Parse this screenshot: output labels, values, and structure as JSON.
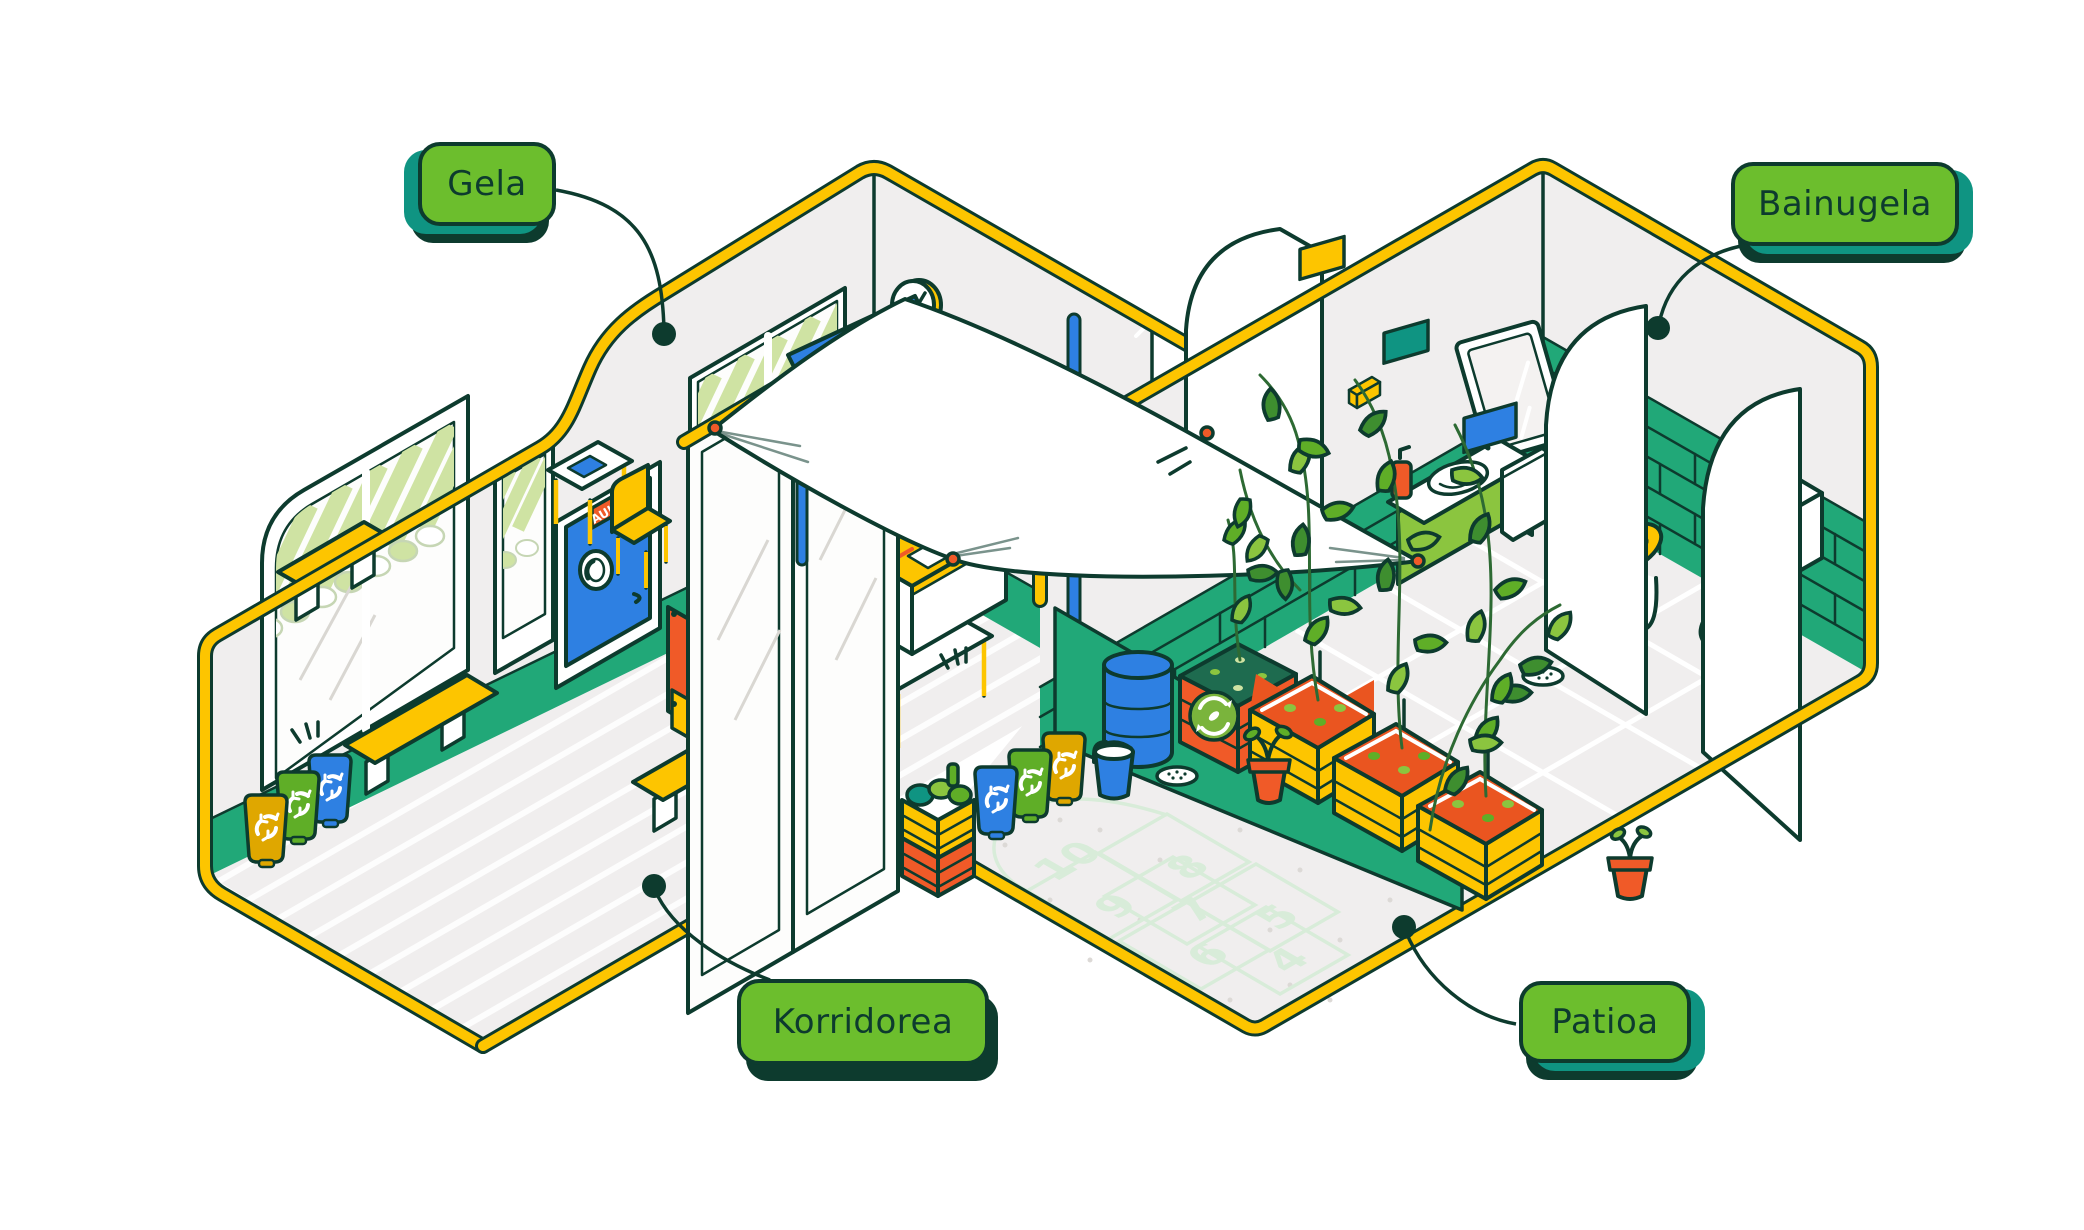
{
  "labels": {
    "classroom": "Gela",
    "bathroom": "Bainugela",
    "corridor": "Korridorea",
    "patio": "Patioa"
  },
  "classroom": {
    "door_sign": "AULA 9"
  },
  "patio": {
    "hopscotch_numbers": [
      "10",
      "9",
      "8",
      "7",
      "6",
      "5",
      "4"
    ]
  },
  "colors": {
    "dark": "#0D3B2E",
    "green": "#6CBE2D",
    "teal": "#0F9482",
    "yellow": "#FDC500",
    "mustard": "#DFA700",
    "emerald": "#21A878",
    "blue": "#2E80E2",
    "orange": "#F05A28",
    "lime": "#8BC53F",
    "leaf": "#5FAE27",
    "leafdark": "#3E8E2F",
    "lightleaf": "#CFE3A3",
    "palegreen": "#D8ECD9",
    "chalk": "#1C7C66",
    "gray": "#F0EEEE",
    "soil": "#EA5520",
    "compost": "#1E6B4F"
  }
}
